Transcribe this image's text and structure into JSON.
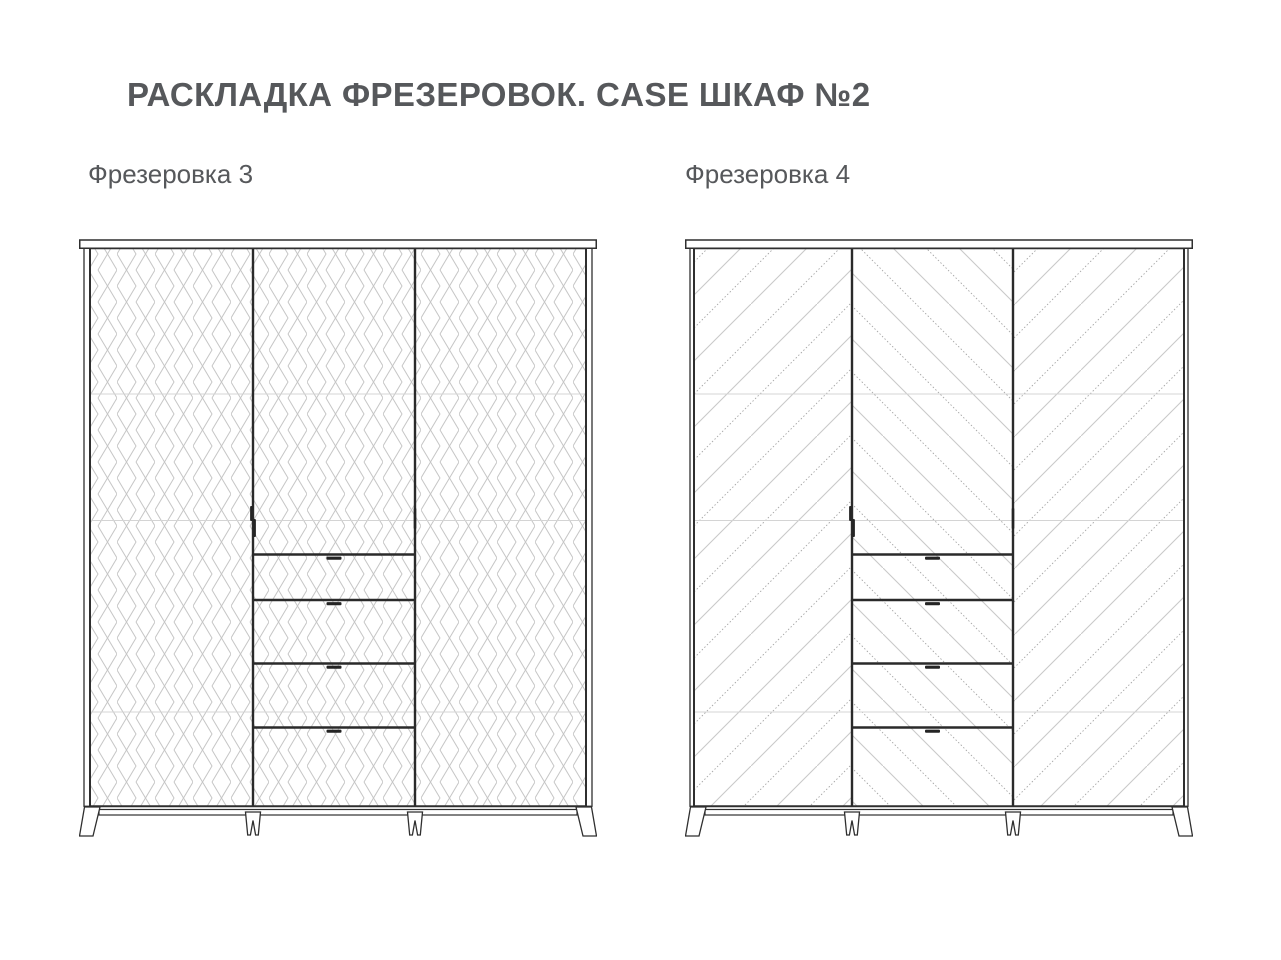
{
  "diagram": {
    "title": "РАСКЛАДКА ФРЕЗЕРОВОК. CASE ШКАФ №2",
    "figures": [
      {
        "label": "Фрезеровка 3",
        "milling_pattern": "diamond-cube-lattice",
        "doors": 3,
        "drawers": 4
      },
      {
        "label": "Фрезеровка 4",
        "milling_pattern": "diagonal-chevron",
        "doors": 3,
        "drawers": 4
      }
    ],
    "colors": {
      "background": "#ffffff",
      "outline": "#2f2f2f",
      "pattern_light": "#c9c9c9",
      "pattern_accent": "#a6a6a6",
      "shelf_line": "#d4d4d4",
      "text": "#56585b"
    }
  }
}
